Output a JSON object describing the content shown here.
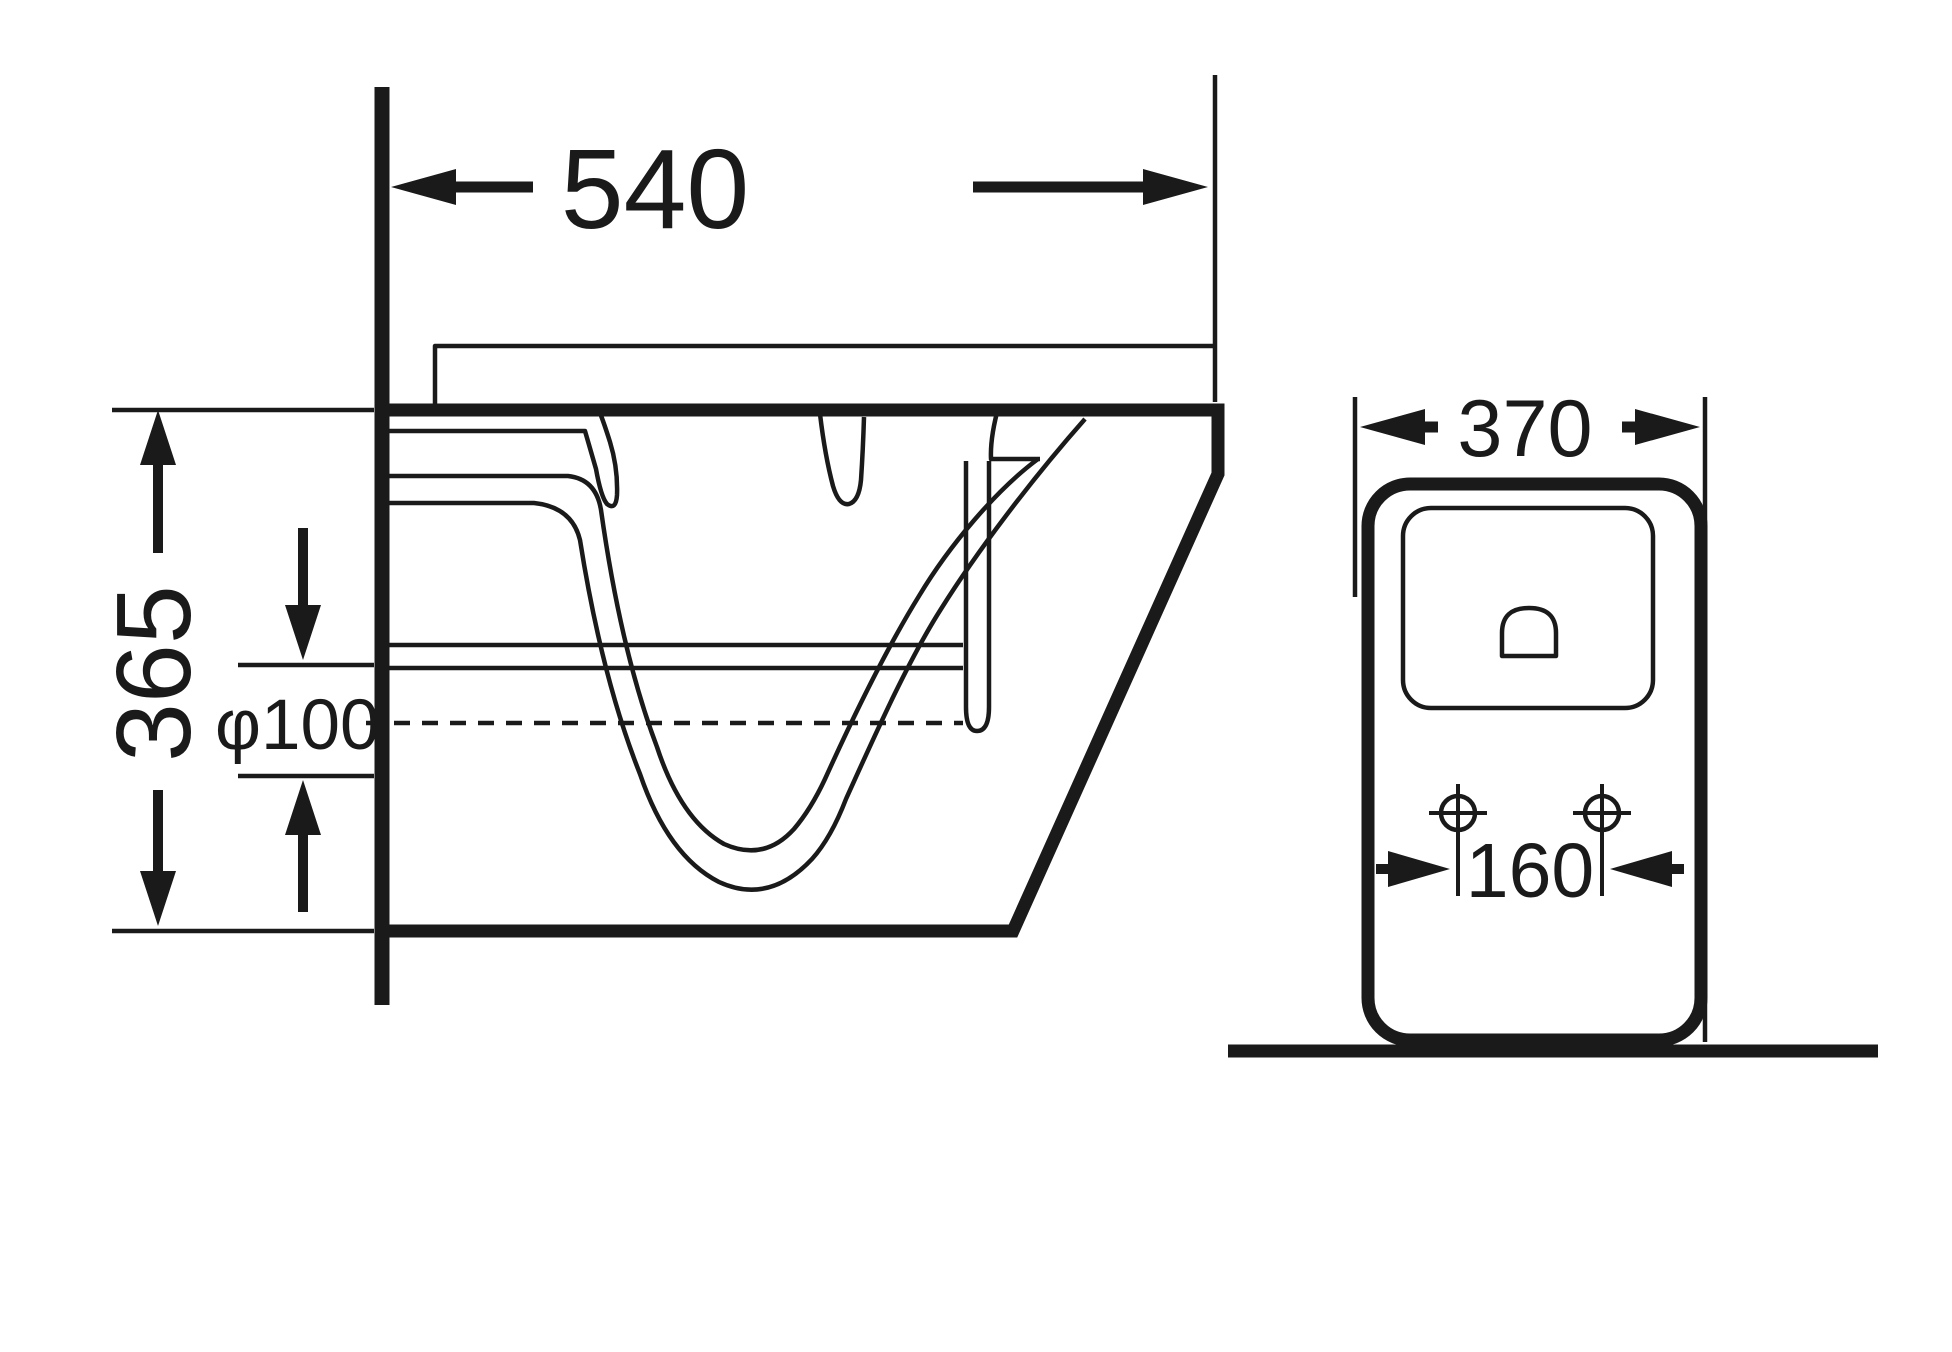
{
  "side_view": {
    "depth_label": "540",
    "height_label": "365",
    "outlet_label": "φ100"
  },
  "back_view": {
    "width_label": "370",
    "hole_spacing_label": "160"
  },
  "colors": {
    "line": "#1a1a1a",
    "background": "#ffffff"
  }
}
